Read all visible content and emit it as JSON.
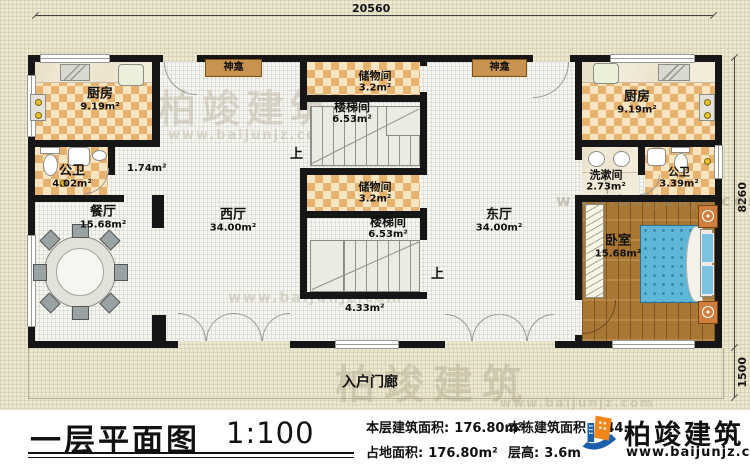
{
  "plan": {
    "dimensions": {
      "width_top": "20560",
      "height_main": "8260",
      "height_porch": "1500"
    },
    "rooms": {
      "kitchen_left": {
        "name": "厨房",
        "area": "9.19m²"
      },
      "bath_left": {
        "name": "公卫",
        "area": "4.02m²"
      },
      "corridor": {
        "area": "1.74m²"
      },
      "dining": {
        "name": "餐厅",
        "area": "15.68m²"
      },
      "west_hall": {
        "name": "西厅",
        "area": "34.00m²"
      },
      "storage_top": {
        "name": "储物间",
        "area": "3.2m²"
      },
      "stair_top": {
        "name": "楼梯间",
        "area": "6.53m²"
      },
      "storage_bottom": {
        "name": "储物间",
        "area": "3.2m²"
      },
      "stair_bottom": {
        "name": "楼梯间",
        "area": "6.53m²"
      },
      "east_hall": {
        "name": "东厅",
        "area": "34.00m²"
      },
      "kitchen_right": {
        "name": "厨房",
        "area": "9.19m²"
      },
      "washroom": {
        "name": "洗漱间",
        "area": "2.73m²"
      },
      "bath_right": {
        "name": "公卫",
        "area": "3.39m²"
      },
      "bedroom": {
        "name": "卧室",
        "area": "15.68m²"
      },
      "entry_nook": {
        "area": "4.33m²"
      },
      "porch": {
        "name": "入户门廊"
      }
    },
    "labels": {
      "shrine": "神龛",
      "up": "上"
    }
  },
  "watermark": {
    "brand": "柏竣建筑",
    "url": "www.baijunjz.com"
  },
  "title_block": {
    "title": "一层平面图",
    "scale": "1:100",
    "stats": [
      {
        "label": "本层建筑面积:",
        "value": "176.80m²"
      },
      {
        "label": "占地面积:",
        "value": "176.80m²"
      },
      {
        "label": "本栋建筑面积:",
        "value": "544."
      },
      {
        "label": "层高:",
        "value": "3.6m"
      }
    ],
    "logo": {
      "brand": "柏竣建筑",
      "url": "www.baijunjz.com"
    }
  },
  "colors": {
    "wall": "#161616",
    "tile": "#e6b26e",
    "wood": "#a87733",
    "bed": "#5fb6d7",
    "logo_blue": "#1b5eaa",
    "logo_orange": "#f08519"
  }
}
